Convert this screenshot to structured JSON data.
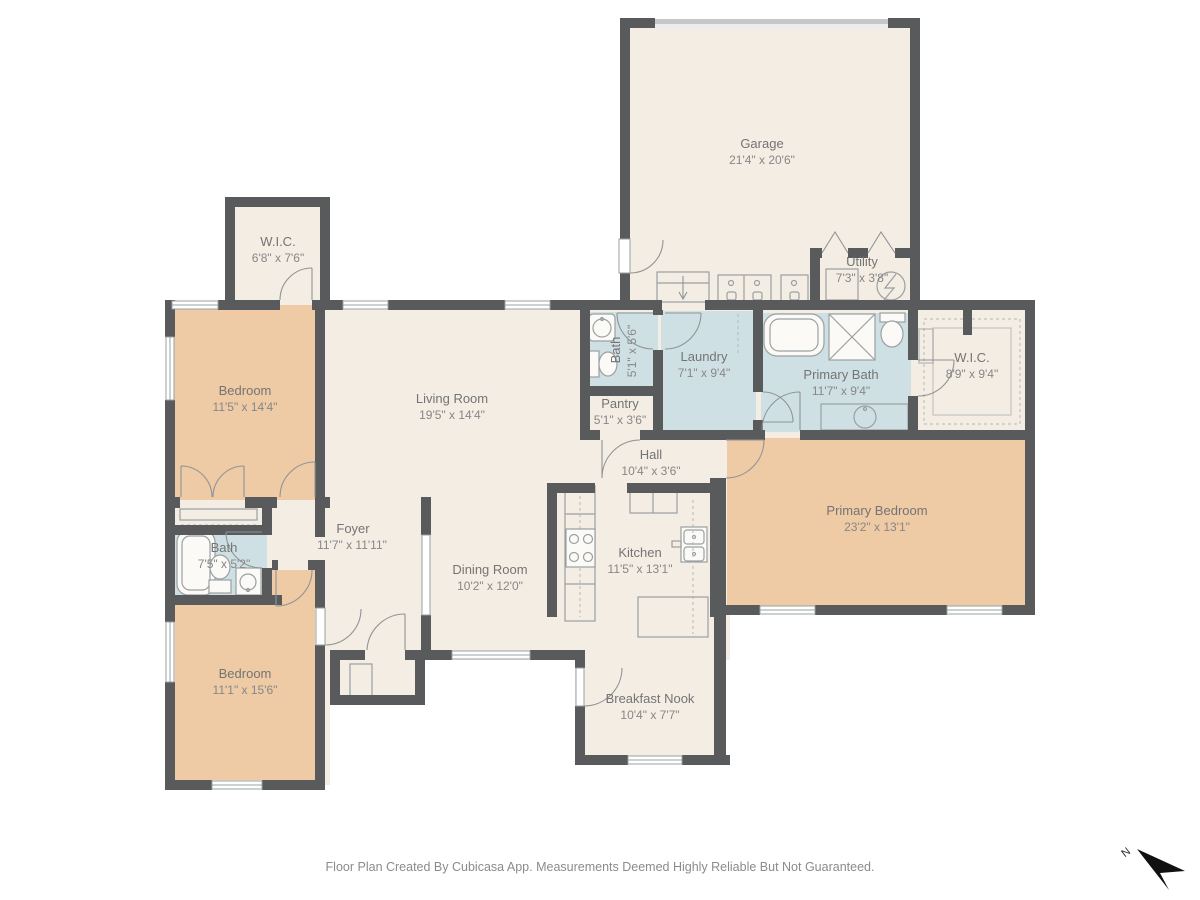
{
  "rooms": [
    {
      "id": "garage",
      "name": "Garage",
      "dims": "21'4\" x 20'6\""
    },
    {
      "id": "wic-upper",
      "name": "W.I.C.",
      "dims": "6'8\" x 7'6\""
    },
    {
      "id": "bedroom-upper",
      "name": "Bedroom",
      "dims": "11'5\" x 14'4\""
    },
    {
      "id": "living-room",
      "name": "Living Room",
      "dims": "19'5\" x 14'4\""
    },
    {
      "id": "hall-bath",
      "name": "Bath",
      "dims": "5'1\" x 5'6\""
    },
    {
      "id": "laundry",
      "name": "Laundry",
      "dims": "7'1\" x 9'4\""
    },
    {
      "id": "utility",
      "name": "Utility",
      "dims": "7'3\" x 3'8\""
    },
    {
      "id": "primary-bath",
      "name": "Primary Bath",
      "dims": "11'7\" x 9'4\""
    },
    {
      "id": "primary-wic",
      "name": "W.I.C.",
      "dims": "8'9\" x 9'4\""
    },
    {
      "id": "pantry",
      "name": "Pantry",
      "dims": "5'1\" x 3'6\""
    },
    {
      "id": "hall",
      "name": "Hall",
      "dims": "10'4\" x 3'6\""
    },
    {
      "id": "foyer",
      "name": "Foyer",
      "dims": "11'7\" x 11'11\""
    },
    {
      "id": "front-bath",
      "name": "Bath",
      "dims": "7'5\" x 5'2\""
    },
    {
      "id": "dining-room",
      "name": "Dining Room",
      "dims": "10'2\" x 12'0\""
    },
    {
      "id": "kitchen",
      "name": "Kitchen",
      "dims": "11'5\" x 13'1\""
    },
    {
      "id": "primary-bedroom",
      "name": "Primary Bedroom",
      "dims": "23'2\" x 13'1\""
    },
    {
      "id": "bedroom-lower",
      "name": "Bedroom",
      "dims": "11'1\" x 15'6\""
    },
    {
      "id": "breakfast-nook",
      "name": "Breakfast Nook",
      "dims": "10'4\" x 7'7\""
    }
  ],
  "annotations": {
    "footer": "Floor Plan Created By Cubicasa App. Measurements Deemed Highly Reliable But Not Guaranteed.",
    "compass_label": "N"
  },
  "colors": {
    "wall": "#595a5c",
    "floor": "#f3ede4",
    "bedroom_floor": "#eecaa5",
    "wet_floor": "#cfe0e4",
    "garage_door": "#c7c7c7",
    "compass": "#111111"
  }
}
